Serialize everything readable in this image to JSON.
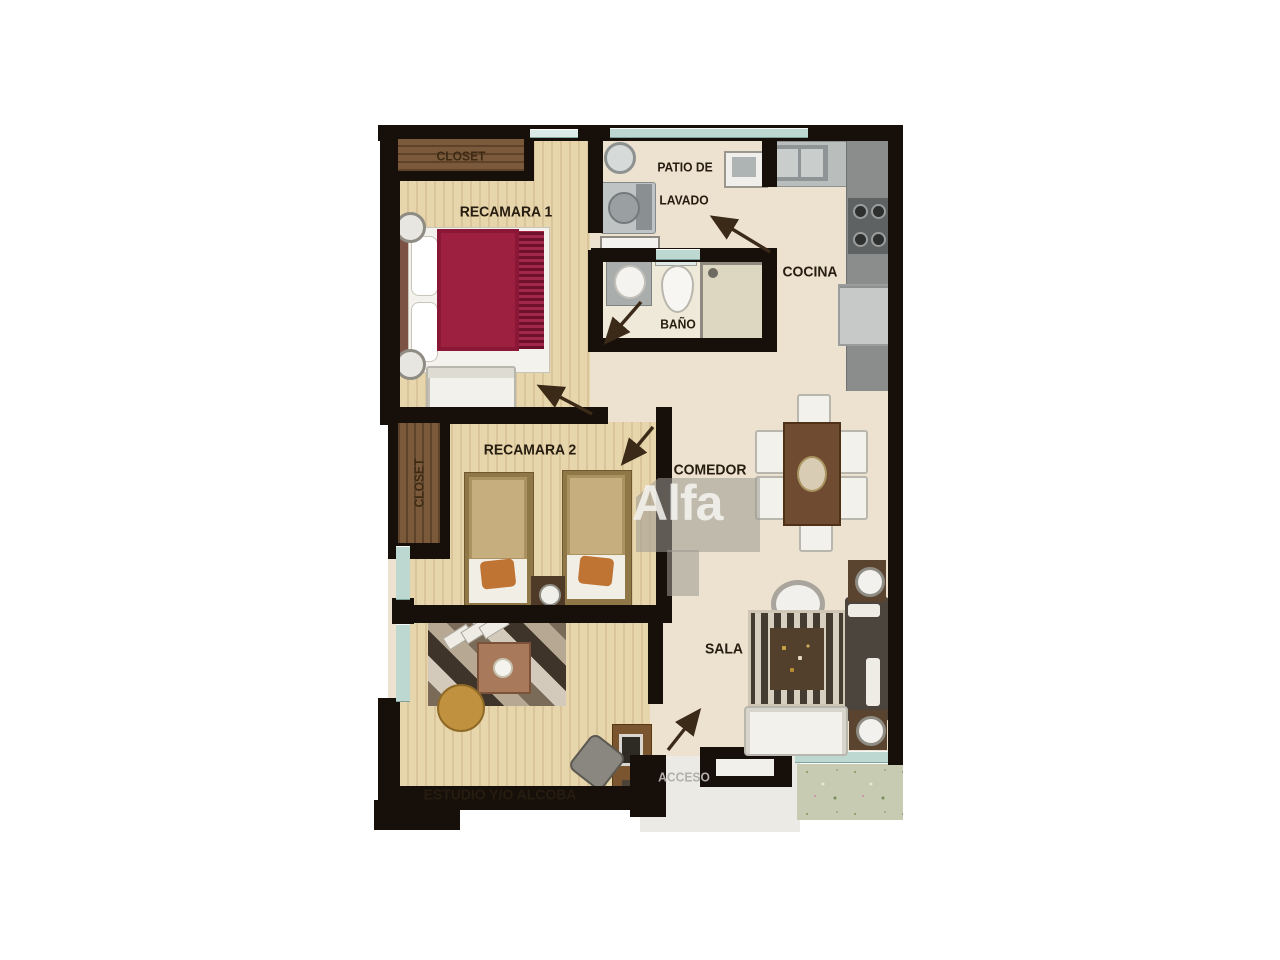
{
  "rooms": {
    "recamara1": {
      "label": "RECAMARA 1"
    },
    "closet1": {
      "label": "CLOSET"
    },
    "patio": {
      "label_line1": "PATIO DE",
      "label_line2": "LAVADO"
    },
    "bano": {
      "label": "BAÑO"
    },
    "cocina": {
      "label": "COCINA"
    },
    "recamara2": {
      "label": "RECAMARA 2"
    },
    "closet2": {
      "label": "CLOSET"
    },
    "comedor": {
      "label": "COMEDOR"
    },
    "sala": {
      "label": "SALA"
    },
    "estudio": {
      "label": "ESTUDIO Y/O ALCOBA"
    },
    "acceso": {
      "label": "ACCESO"
    }
  },
  "watermark": {
    "text": "Alfa"
  },
  "colors": {
    "wall": "#17100a",
    "floor_beige": "#ece2cf",
    "floor_wood": "#e7d5ac",
    "window_teal": "#bdd8d1",
    "bed_cover_red": "#9e2040",
    "closet_wood": "#7b5a3c",
    "table_wood": "#6f4c31",
    "garden_green": "#c6cbb2",
    "watermark_gray": "#9e9b94"
  }
}
